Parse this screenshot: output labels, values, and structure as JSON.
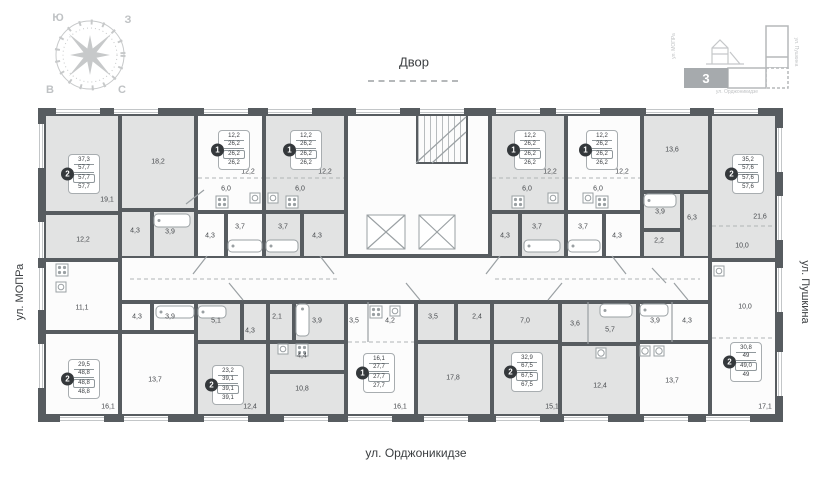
{
  "labels": {
    "courtyard": "Двор",
    "street_left": "ул. МОПРа",
    "street_right": "ул. Пушкина",
    "street_bottom": "ул. Орджоникидзе"
  },
  "compass": {
    "top_left": "Ю",
    "top_right": "З",
    "bottom_left": "В",
    "bottom_right": "С"
  },
  "minimap": {
    "current_section": "3",
    "street_left": "ул. МОПРа",
    "street_right": "ул. Пушкина",
    "street_bottom": "ул. Орджоникидзе"
  },
  "plan": {
    "wall_color": "#575c60",
    "fill_gray": "#e2e3e3",
    "fill_white": "#fcfcfc",
    "rooms": [
      [
        44,
        114,
        76,
        99,
        "g"
      ],
      [
        120,
        114,
        76,
        96,
        "g"
      ],
      [
        44,
        213,
        76,
        47,
        "g"
      ],
      [
        120,
        210,
        32,
        50,
        "g"
      ],
      [
        152,
        210,
        44,
        50,
        "g"
      ],
      [
        196,
        114,
        68,
        98,
        "w"
      ],
      [
        196,
        212,
        30,
        48,
        "w"
      ],
      [
        226,
        212,
        38,
        48,
        "w"
      ],
      [
        264,
        114,
        82,
        98,
        "g"
      ],
      [
        264,
        212,
        38,
        48,
        "g"
      ],
      [
        302,
        212,
        44,
        48,
        "g"
      ],
      [
        346,
        114,
        144,
        142,
        "w"
      ],
      [
        416,
        114,
        52,
        50,
        "h"
      ],
      [
        490,
        114,
        76,
        98,
        "g"
      ],
      [
        490,
        212,
        30,
        48,
        "g"
      ],
      [
        520,
        212,
        46,
        48,
        "g"
      ],
      [
        566,
        114,
        76,
        98,
        "w"
      ],
      [
        566,
        212,
        38,
        48,
        "w"
      ],
      [
        604,
        212,
        38,
        48,
        "w"
      ],
      [
        642,
        114,
        68,
        78,
        "g"
      ],
      [
        642,
        192,
        40,
        38,
        "g"
      ],
      [
        642,
        230,
        40,
        30,
        "g"
      ],
      [
        682,
        192,
        28,
        68,
        "g"
      ],
      [
        710,
        114,
        67,
        146,
        "g"
      ],
      [
        710,
        260,
        67,
        156,
        "w"
      ],
      [
        120,
        256,
        590,
        46,
        "w"
      ],
      [
        44,
        260,
        76,
        72,
        "w"
      ],
      [
        44,
        332,
        76,
        84,
        "w"
      ],
      [
        120,
        332,
        76,
        84,
        "w"
      ],
      [
        120,
        302,
        32,
        30,
        "w"
      ],
      [
        152,
        302,
        44,
        30,
        "w"
      ],
      [
        196,
        302,
        46,
        40,
        "g"
      ],
      [
        242,
        302,
        26,
        40,
        "g"
      ],
      [
        268,
        302,
        26,
        40,
        "g"
      ],
      [
        294,
        302,
        52,
        40,
        "g"
      ],
      [
        268,
        342,
        78,
        30,
        "g"
      ],
      [
        196,
        342,
        72,
        74,
        "g"
      ],
      [
        268,
        372,
        78,
        44,
        "g"
      ],
      [
        346,
        302,
        70,
        114,
        "w"
      ],
      [
        416,
        302,
        40,
        40,
        "g"
      ],
      [
        456,
        302,
        36,
        40,
        "g"
      ],
      [
        492,
        302,
        68,
        40,
        "g"
      ],
      [
        416,
        342,
        76,
        74,
        "g"
      ],
      [
        492,
        342,
        68,
        74,
        "g"
      ],
      [
        560,
        302,
        78,
        42,
        "g"
      ],
      [
        560,
        344,
        78,
        72,
        "g"
      ],
      [
        638,
        302,
        72,
        40,
        "w"
      ],
      [
        638,
        342,
        72,
        74,
        "w"
      ]
    ],
    "room_labels": [
      [
        "18,2",
        158,
        162
      ],
      [
        "19,1",
        107,
        200
      ],
      [
        "12,2",
        83,
        240
      ],
      [
        "4,3",
        135,
        231
      ],
      [
        "3,9",
        170,
        232
      ],
      [
        "12,2",
        248,
        172
      ],
      [
        "6,0",
        226,
        189
      ],
      [
        "4,3",
        210,
        236
      ],
      [
        "3,7",
        240,
        227
      ],
      [
        "12,2",
        325,
        172
      ],
      [
        "6,0",
        300,
        189
      ],
      [
        "3,7",
        283,
        227
      ],
      [
        "4,3",
        317,
        236
      ],
      [
        "12,2",
        550,
        172
      ],
      [
        "6,0",
        527,
        189
      ],
      [
        "4,3",
        505,
        236
      ],
      [
        "3,7",
        537,
        227
      ],
      [
        "12,2",
        622,
        172
      ],
      [
        "6,0",
        598,
        189
      ],
      [
        "3,7",
        583,
        227
      ],
      [
        "4,3",
        617,
        236
      ],
      [
        "13,6",
        672,
        150
      ],
      [
        "3,9",
        660,
        212
      ],
      [
        "6,3",
        692,
        218
      ],
      [
        "2,2",
        659,
        241
      ],
      [
        "21,6",
        760,
        217
      ],
      [
        "10,0",
        742,
        246
      ],
      [
        "11,1",
        82,
        308
      ],
      [
        "16,1",
        108,
        407
      ],
      [
        "13,7",
        155,
        380
      ],
      [
        "4,3",
        137,
        317
      ],
      [
        "3,9",
        170,
        317
      ],
      [
        "5,1",
        216,
        321
      ],
      [
        "4,3",
        250,
        331
      ],
      [
        "2,1",
        277,
        317
      ],
      [
        "3,9",
        317,
        321
      ],
      [
        "4,4",
        302,
        356
      ],
      [
        "12,4",
        250,
        407
      ],
      [
        "10,8",
        302,
        389
      ],
      [
        "3,5",
        354,
        321
      ],
      [
        "4,2",
        390,
        321
      ],
      [
        "16,1",
        400,
        407
      ],
      [
        "3,5",
        433,
        317
      ],
      [
        "2,4",
        477,
        317
      ],
      [
        "7,0",
        525,
        321
      ],
      [
        "17,8",
        453,
        378
      ],
      [
        "15,1",
        552,
        407
      ],
      [
        "3,6",
        575,
        324
      ],
      [
        "5,7",
        610,
        330
      ],
      [
        "12,4",
        600,
        386
      ],
      [
        "3,9",
        655,
        321
      ],
      [
        "4,3",
        687,
        321
      ],
      [
        "13,7",
        672,
        381
      ],
      [
        "10,0",
        745,
        307
      ],
      [
        "17,1",
        765,
        407
      ]
    ],
    "apartments": [
      {
        "badge": "2",
        "lines": [
          "37,3",
          "57,7",
          "57,7",
          "57,7"
        ],
        "x": 84,
        "y": 174
      },
      {
        "badge": "1",
        "lines": [
          "12,2",
          "26,2",
          "26,2",
          "26,2"
        ],
        "x": 234,
        "y": 150
      },
      {
        "badge": "1",
        "lines": [
          "12,2",
          "26,2",
          "26,2",
          "26,2"
        ],
        "x": 306,
        "y": 150
      },
      {
        "badge": "1",
        "lines": [
          "12,2",
          "26,2",
          "26,2",
          "26,2"
        ],
        "x": 530,
        "y": 150
      },
      {
        "badge": "1",
        "lines": [
          "12,2",
          "26,2",
          "26,2",
          "26,2"
        ],
        "x": 602,
        "y": 150
      },
      {
        "badge": "2",
        "lines": [
          "35,2",
          "57,6",
          "57,6",
          "57,6"
        ],
        "x": 748,
        "y": 174
      },
      {
        "badge": "2",
        "lines": [
          "29,5",
          "48,8",
          "48,8",
          "48,8"
        ],
        "x": 84,
        "y": 379
      },
      {
        "badge": "2",
        "lines": [
          "23,2",
          "39,1",
          "39,1",
          "39,1"
        ],
        "x": 228,
        "y": 385
      },
      {
        "badge": "1",
        "lines": [
          "16,1",
          "27,7",
          "27,7",
          "27,7"
        ],
        "x": 379,
        "y": 373
      },
      {
        "badge": "2",
        "lines": [
          "32,9",
          "67,5",
          "67,5",
          "67,5"
        ],
        "x": 527,
        "y": 372
      },
      {
        "badge": "2",
        "lines": [
          "30,8",
          "49",
          "49,0",
          "49"
        ],
        "x": 746,
        "y": 362
      }
    ],
    "windows": {
      "top": [
        [
          56,
          100
        ],
        [
          114,
          158
        ],
        [
          204,
          248
        ],
        [
          268,
          312
        ],
        [
          356,
          400
        ],
        [
          420,
          464
        ],
        [
          496,
          540
        ],
        [
          556,
          600
        ],
        [
          646,
          690
        ],
        [
          714,
          758
        ]
      ],
      "bottom": [
        [
          60,
          104
        ],
        [
          124,
          168
        ],
        [
          204,
          248
        ],
        [
          284,
          328
        ],
        [
          348,
          392
        ],
        [
          424,
          468
        ],
        [
          496,
          540
        ],
        [
          564,
          608
        ],
        [
          644,
          688
        ],
        [
          706,
          750
        ]
      ],
      "left": [
        [
          124,
          168
        ],
        [
          222,
          258
        ],
        [
          268,
          310
        ],
        [
          344,
          388
        ]
      ],
      "right": [
        [
          128,
          172
        ],
        [
          196,
          240
        ],
        [
          268,
          312
        ],
        [
          352,
          396
        ]
      ]
    },
    "elevators": [
      [
        362,
        210,
        48,
        44
      ],
      [
        414,
        210,
        46,
        44
      ]
    ],
    "fixtures": [
      [
        "tub",
        154,
        214,
        36,
        13
      ],
      [
        "tub",
        228,
        240,
        34,
        12
      ],
      [
        "tub",
        266,
        240,
        32,
        12
      ],
      [
        "tub",
        524,
        240,
        36,
        12
      ],
      [
        "tub",
        568,
        240,
        32,
        12
      ],
      [
        "tub",
        644,
        194,
        32,
        13
      ],
      [
        "tub",
        156,
        306,
        38,
        12
      ],
      [
        "tub",
        198,
        306,
        28,
        12
      ],
      [
        "tub",
        600,
        304,
        32,
        13
      ],
      [
        "tub",
        296,
        304,
        13,
        32
      ],
      [
        "tub",
        640,
        304,
        28,
        12
      ],
      [
        "stove",
        216,
        196,
        12,
        12
      ],
      [
        "stove",
        286,
        196,
        12,
        12
      ],
      [
        "stove",
        512,
        196,
        12,
        12
      ],
      [
        "stove",
        596,
        196,
        12,
        12
      ],
      [
        "stove",
        56,
        264,
        12,
        12
      ],
      [
        "stove",
        296,
        344,
        12,
        12
      ],
      [
        "stove",
        370,
        306,
        12,
        12
      ],
      [
        "sink",
        250,
        193,
        10,
        10
      ],
      [
        "sink",
        268,
        193,
        10,
        10
      ],
      [
        "sink",
        548,
        193,
        10,
        10
      ],
      [
        "sink",
        583,
        193,
        10,
        10
      ],
      [
        "sink",
        56,
        282,
        10,
        10
      ],
      [
        "sink",
        278,
        344,
        10,
        10
      ],
      [
        "sink",
        390,
        306,
        10,
        10
      ],
      [
        "sink",
        714,
        266,
        10,
        10
      ],
      [
        "washer",
        596,
        348,
        10,
        10
      ],
      [
        "washer",
        640,
        346,
        10,
        10
      ],
      [
        "washer",
        654,
        346,
        10,
        10
      ]
    ],
    "lines_dashed": [
      [
        198,
        178,
        262,
        178
      ],
      [
        266,
        178,
        344,
        178
      ],
      [
        492,
        178,
        564,
        178
      ],
      [
        568,
        178,
        640,
        178
      ],
      [
        712,
        226,
        775,
        226
      ],
      [
        712,
        338,
        775,
        338
      ],
      [
        348,
        342,
        414,
        342
      ],
      [
        130,
        279,
        340,
        279
      ],
      [
        495,
        279,
        700,
        279
      ]
    ],
    "lines_solid": [
      [
        368,
        302,
        368,
        342
      ],
      [
        588,
        302,
        588,
        344
      ],
      [
        672,
        302,
        672,
        342
      ],
      [
        416,
        163,
        466,
        117
      ],
      [
        432,
        163,
        466,
        132
      ],
      [
        207,
        256,
        193,
        274
      ],
      [
        320,
        256,
        334,
        274
      ],
      [
        500,
        256,
        486,
        274
      ],
      [
        612,
        256,
        626,
        274
      ],
      [
        243,
        300,
        229,
        283
      ],
      [
        420,
        300,
        406,
        283
      ],
      [
        548,
        300,
        562,
        283
      ],
      [
        688,
        300,
        674,
        283
      ],
      [
        186,
        204,
        204,
        190
      ],
      [
        652,
        268,
        666,
        283
      ]
    ]
  }
}
